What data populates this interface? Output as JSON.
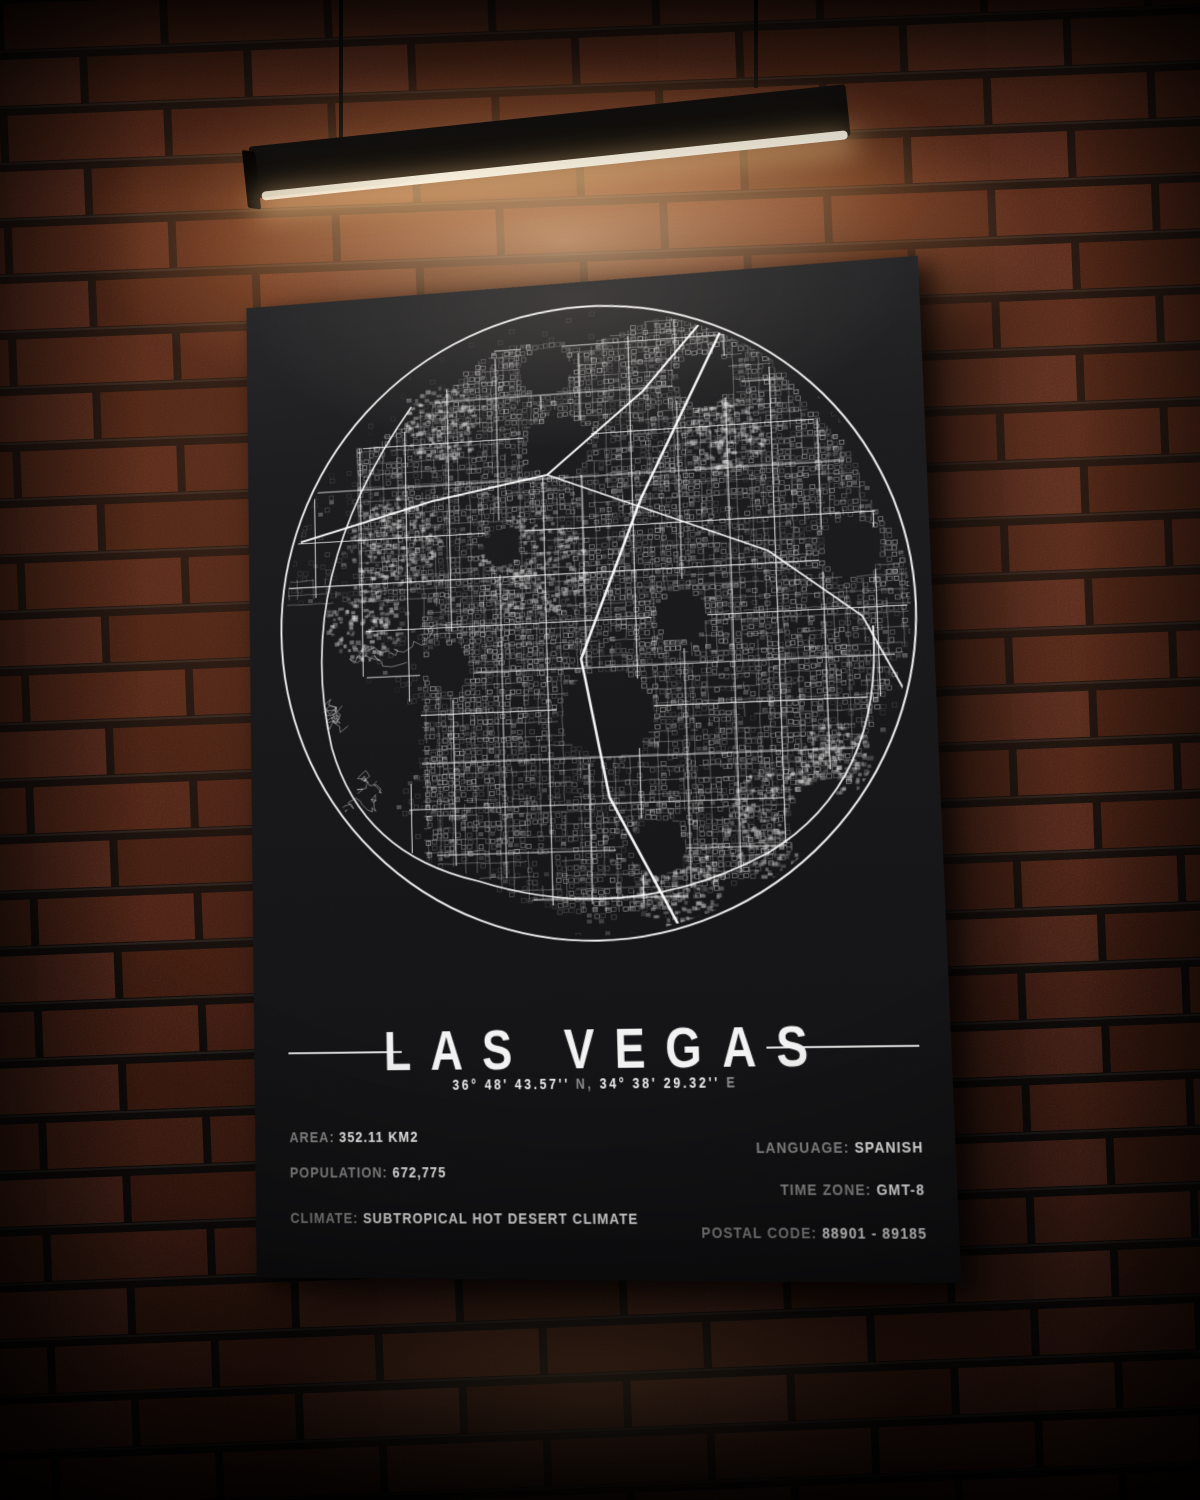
{
  "poster": {
    "title": "LAS VEGAS",
    "coordinates": {
      "lat_value": "36° 48' 43.57''",
      "lat_suffix": "N,",
      "lon_value": "34° 38' 29.32''",
      "lon_suffix": "E"
    },
    "info_left": [
      {
        "label": "AREA:",
        "value": "352.11 KM2"
      },
      {
        "label": "POPULATION:",
        "value": "672,775"
      },
      {
        "label": "CLIMATE:",
        "value": "SUBTROPICAL HOT DESERT CLIMATE"
      }
    ],
    "info_right": [
      {
        "label": "LANGUAGE:",
        "value": "SPANISH"
      },
      {
        "label": "TIME ZONE:",
        "value": "GMT-8"
      },
      {
        "label": "POSTAL CODE:",
        "value": "88901 - 89185"
      }
    ]
  },
  "colors": {
    "poster_background": "#19191b",
    "map_ink": "#ffffff",
    "label_gray": "#8f8f8f",
    "brick": "#66301f",
    "mortar": "#171210",
    "lamp_glow": "#fff6e2"
  }
}
